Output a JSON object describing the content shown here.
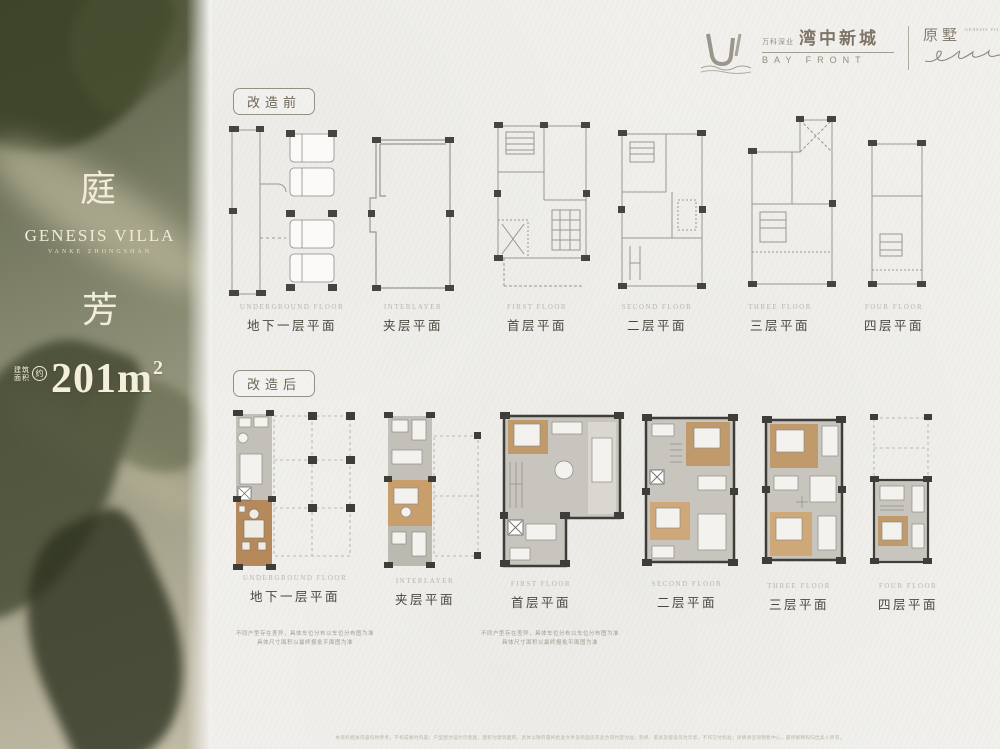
{
  "brand": {
    "logo_group": "万科深业",
    "logo_cn": "湾中新城",
    "logo_en": "BAY FRONT",
    "logo_sub": "原墅",
    "logo_sub_en": "GENESIS VILLA"
  },
  "sidebar": {
    "title_char_1": "庭",
    "title_en": "GENESIS VILLA",
    "title_sub": "VANKE ZHONGSHAN",
    "title_char_2": "芳",
    "area_label_1": "建筑",
    "area_label_2": "面积",
    "area_circle": "约",
    "area_value": "201m",
    "area_sup": "2"
  },
  "sections": {
    "before": {
      "badge": "改造前",
      "plans": [
        {
          "en": "UNDERGROUND FLOOR",
          "cn": "地下一层平面"
        },
        {
          "en": "INTERLAYER",
          "cn": "夹层平面"
        },
        {
          "en": "FIRST FLOOR",
          "cn": "首层平面"
        },
        {
          "en": "SECOND FLOOR",
          "cn": "二层平面"
        },
        {
          "en": "THREE FLOOR",
          "cn": "三层平面"
        },
        {
          "en": "FOUR FLOOR",
          "cn": "四层平面"
        }
      ]
    },
    "after": {
      "badge": "改造后",
      "plans": [
        {
          "en": "UNDERGROUND FLOOR",
          "cn": "地下一层平面"
        },
        {
          "en": "INTERLAYER",
          "cn": "夹层平面"
        },
        {
          "en": "FIRST FLOOR",
          "cn": "首层平面"
        },
        {
          "en": "SECOND FLOOR",
          "cn": "二层平面"
        },
        {
          "en": "THREE FLOOR",
          "cn": "三层平面"
        },
        {
          "en": "FOUR FLOOR",
          "cn": "四层平面"
        }
      ],
      "notes": [
        {
          "line1": "不同户型存在差异，具体车位分布以车位分布图为准",
          "line2": "具体尺寸面积以最终报批平面图为准"
        },
        {
          "line1": "不同户型存在差异，具体车位分布以车位分布图为准",
          "line2": "具体尺寸面积以最终报批平面图为准"
        }
      ]
    }
  },
  "footer": {
    "disclaimer": "本资料相关内容仅供参考，不构成要约内容；户型图为设计示意图，面积为建筑面积，具体以政府最终批准文件及商品房买卖合同约定为准；装修、家具及摆设仅为示意，不作交付标准；详情请咨询销售中心，最终解释权归出卖人所有。"
  },
  "colors": {
    "paper": "#f1f0ec",
    "accent_cream": "#f2ecda",
    "wall_dark": "#3f3d38",
    "line_grey": "#9a978f",
    "floor_grey": "#c6c3bc",
    "wood": "#b98f60"
  }
}
